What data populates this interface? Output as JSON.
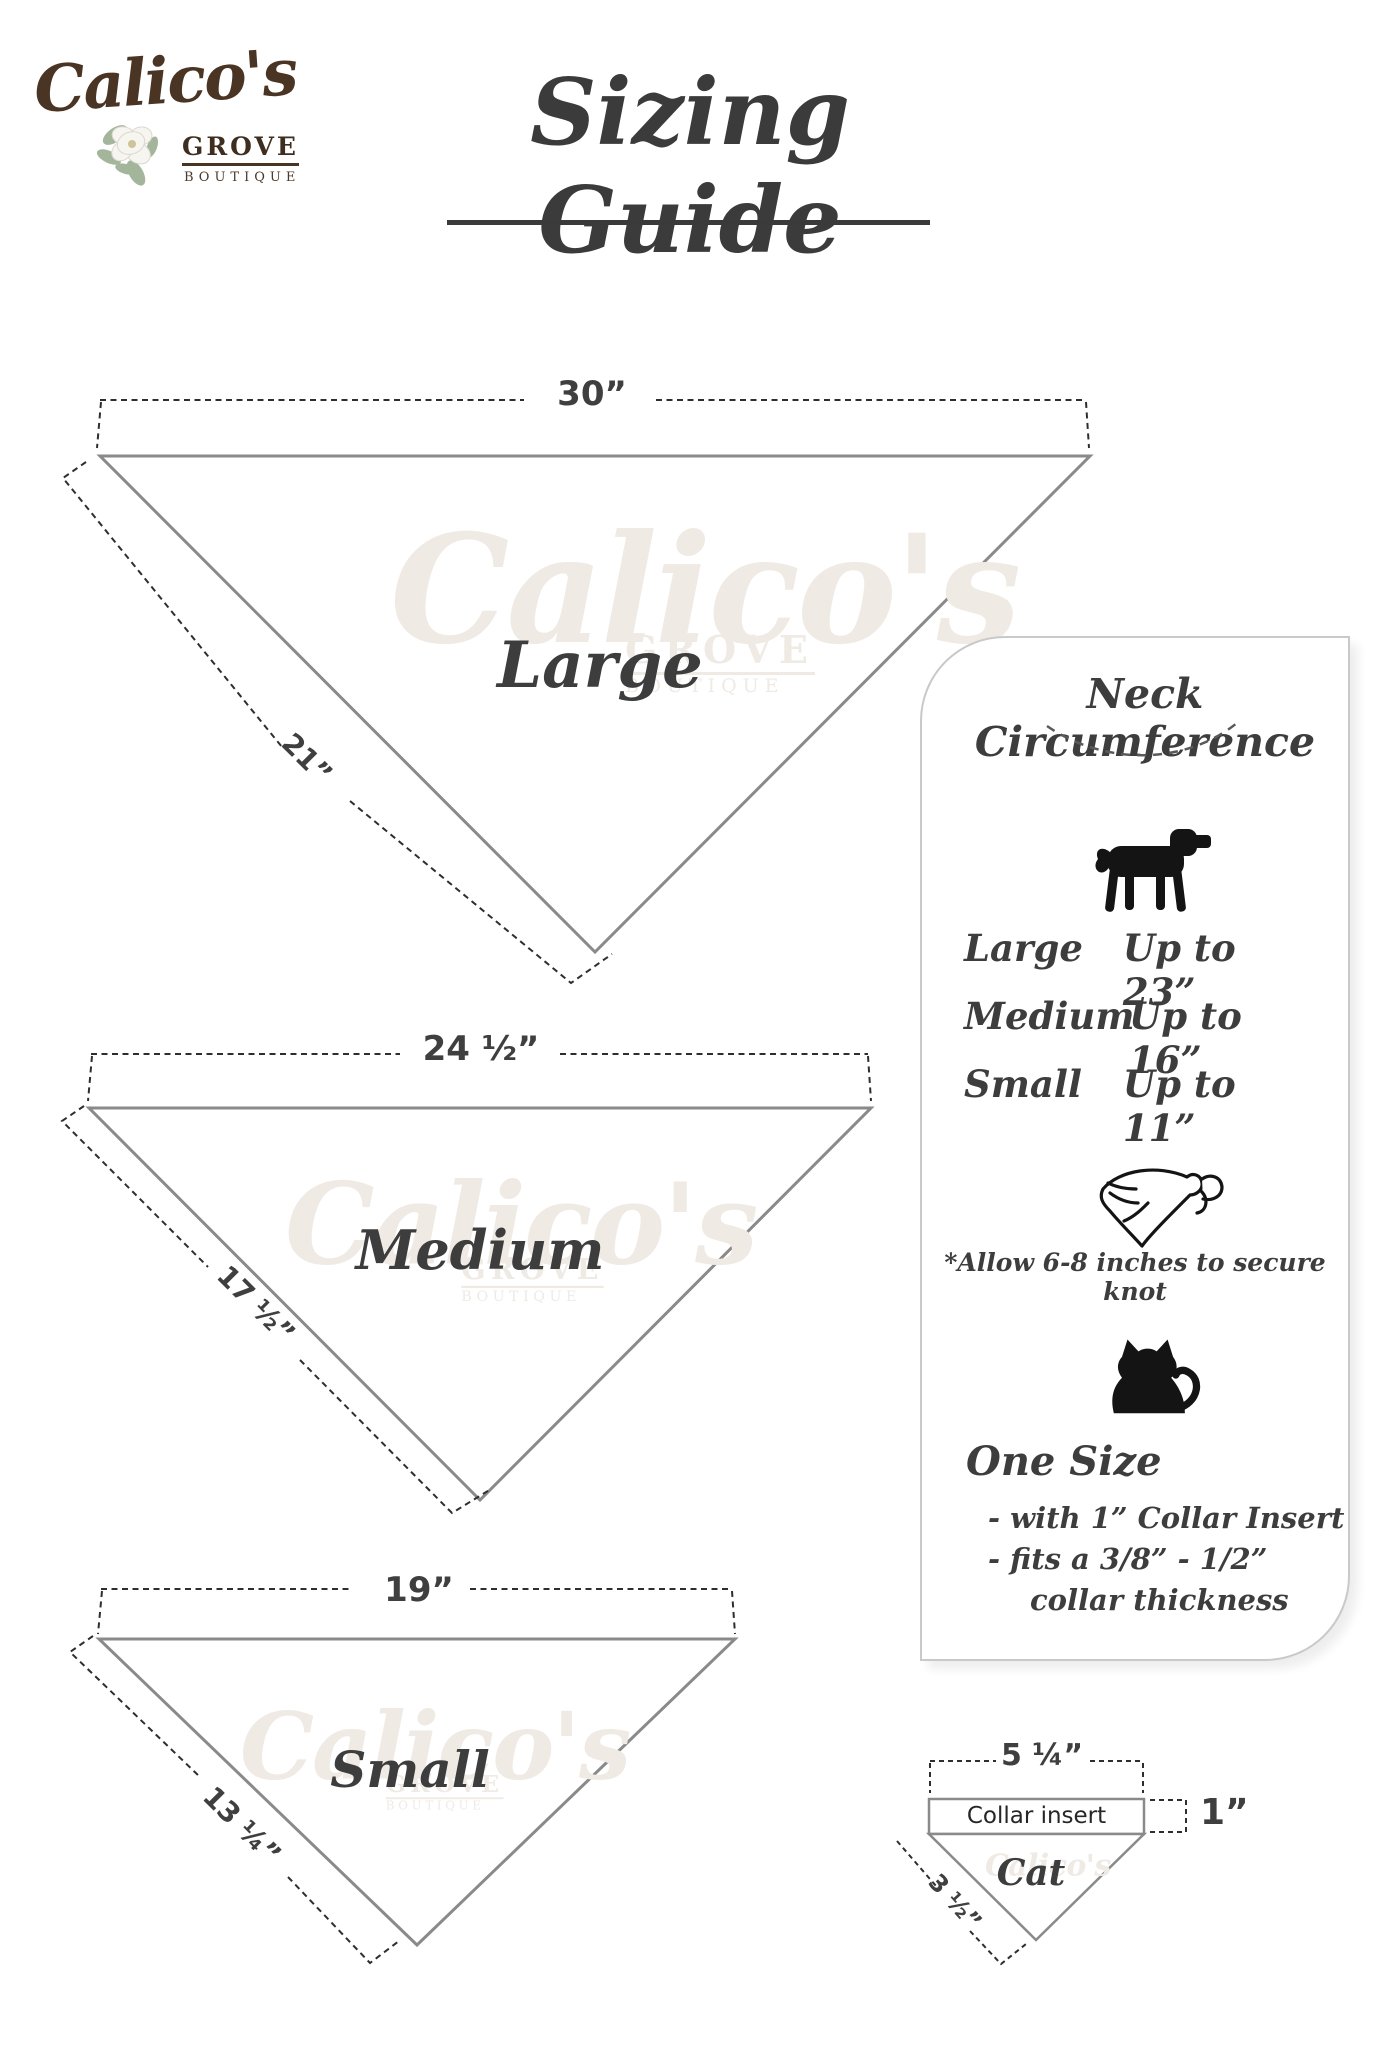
{
  "logo": {
    "script": "Calico's",
    "grove": "GROVE",
    "boutique": "BOUTIQUE"
  },
  "title": "Sizing Guide",
  "watermark": {
    "script": "Calico's",
    "grove": "GROVE",
    "boutique": "BOUTIQUE"
  },
  "bandanas": [
    {
      "label": "Large",
      "top_width": "30”",
      "side_length": "21”"
    },
    {
      "label": "Medium",
      "top_width": "24 ½”",
      "side_length": "17 ½”"
    },
    {
      "label": "Small",
      "top_width": "19”",
      "side_length": "13 ¼”"
    }
  ],
  "panel": {
    "title": "Neck Circumference",
    "dog_icon": "dog-silhouette",
    "rows": [
      {
        "label": "Large",
        "value": "Up to 23”"
      },
      {
        "label": "Medium",
        "value": "Up to 16”"
      },
      {
        "label": "Small",
        "value": "Up to 11”"
      }
    ],
    "bandana_icon": "tied-bandana",
    "knot_note": "*Allow 6-8 inches to secure knot",
    "cat_icon": "cat-silhouette",
    "one_size_heading": "One Size",
    "one_size_lines": [
      "- with 1” Collar Insert",
      "- fits a 3/8” - 1/2”",
      "collar thickness"
    ]
  },
  "cat_diagram": {
    "top_width": "5 ¼”",
    "insert_label": "Collar insert",
    "insert_height": "1”",
    "label": "Cat",
    "side_length": "3 ½”"
  },
  "colors": {
    "triangle_stroke": "#8a8a8a",
    "dash_dark": "#2e2e2e",
    "text_dark": "#3d3d3d",
    "logo_brown": "#4a3423",
    "panel_border": "#c9c9c9"
  }
}
